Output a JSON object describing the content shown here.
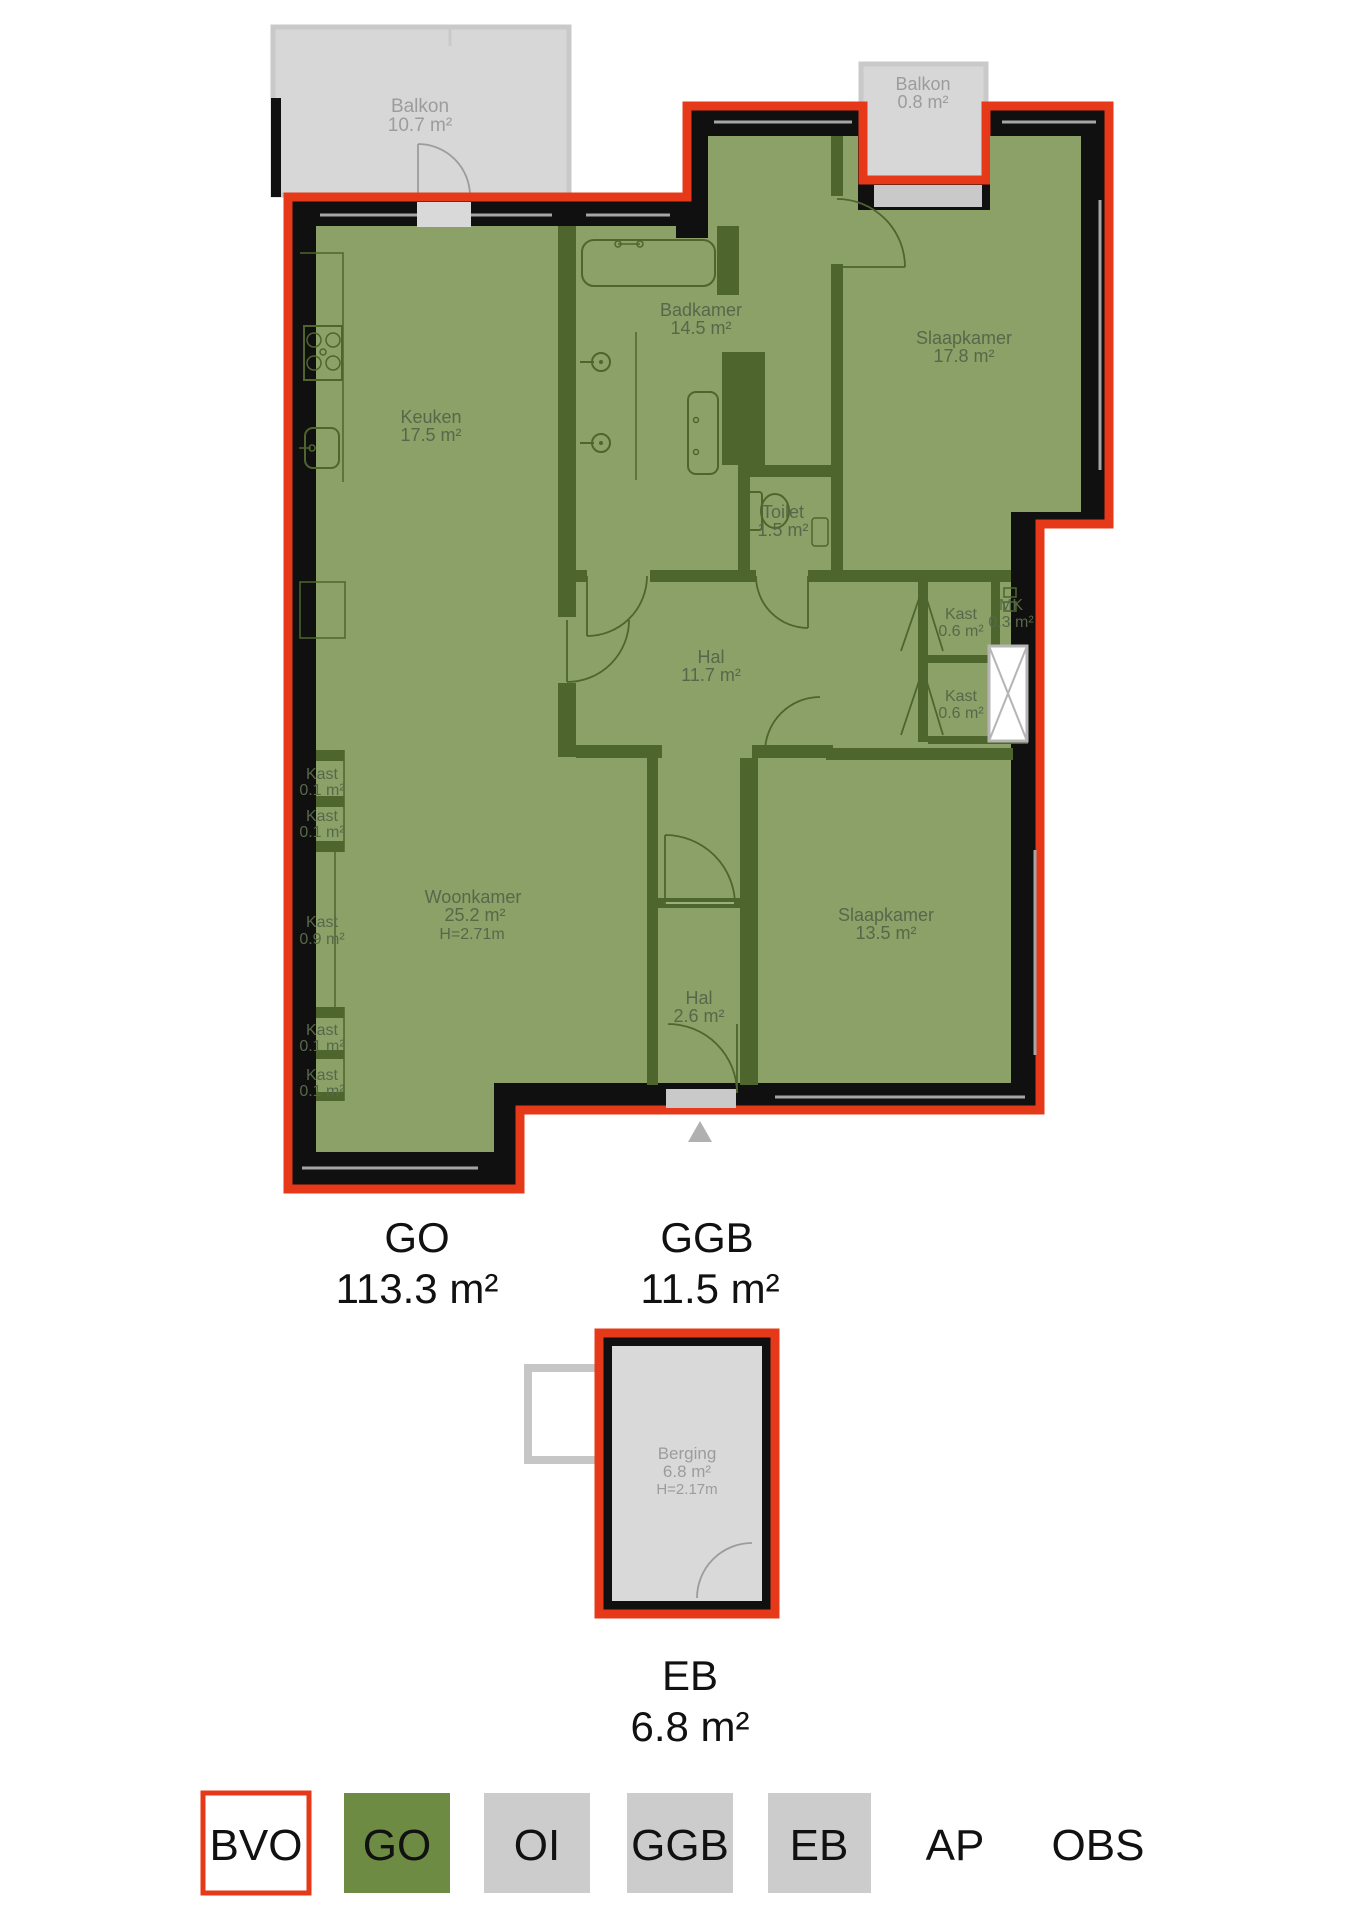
{
  "colors": {
    "bvo_red": "#E6391A",
    "go_green": "#8BA168",
    "wall_green": "#4E652E",
    "legend_green": "#6E8B43",
    "legend_gray": "#CCCCCC",
    "balcony_gray": "#D7D7D7",
    "black": "#101010"
  },
  "balconies": {
    "top_left": {
      "name": "Balkon",
      "area": "10.7 m²"
    },
    "top_right": {
      "name": "Balkon",
      "area": "0.8 m²"
    }
  },
  "rooms": {
    "keuken": {
      "name": "Keuken",
      "area": "17.5 m²"
    },
    "badkamer": {
      "name": "Badkamer",
      "area": "14.5 m²"
    },
    "slaapkamer1": {
      "name": "Slaapkamer",
      "area": "17.8 m²"
    },
    "toilet": {
      "name": "Toilet",
      "area": "1.5 m²"
    },
    "hal1": {
      "name": "Hal",
      "area": "11.7 m²"
    },
    "kast_r1": {
      "name": "Kast",
      "area": "0.6 m²"
    },
    "mk": {
      "name": "MK",
      "area": "0.3 m²"
    },
    "kast_r2": {
      "name": "Kast",
      "area": "0.6 m²"
    },
    "woonkamer": {
      "name": "Woonkamer",
      "area": "25.2 m²",
      "height": "H=2.71m"
    },
    "slaapkamer2": {
      "name": "Slaapkamer",
      "area": "13.5 m²"
    },
    "hal2": {
      "name": "Hal",
      "area": "2.6 m²"
    },
    "kast_l1": {
      "name": "Kast",
      "area": "0.1 m²"
    },
    "kast_l2": {
      "name": "Kast",
      "area": "0.1 m²"
    },
    "kast_l3": {
      "name": "Kast",
      "area": "0.9 m²"
    },
    "kast_l4": {
      "name": "Kast",
      "area": "0.1 m²"
    },
    "kast_l5": {
      "name": "Kast",
      "area": "0.1 m²"
    }
  },
  "outbuilding": {
    "berging": {
      "name": "Berging",
      "area": "6.8 m²",
      "height": "H=2.17m"
    }
  },
  "summaries": {
    "go": {
      "label": "GO",
      "area": "113.3 m²"
    },
    "ggb": {
      "label": "GGB",
      "area": "11.5 m²"
    },
    "eb": {
      "label": "EB",
      "area": "6.8 m²"
    }
  },
  "legend": {
    "items": [
      {
        "label": "BVO"
      },
      {
        "label": "GO"
      },
      {
        "label": "OI"
      },
      {
        "label": "GGB"
      },
      {
        "label": "EB"
      },
      {
        "label": "AP"
      },
      {
        "label": "OBS"
      }
    ]
  }
}
